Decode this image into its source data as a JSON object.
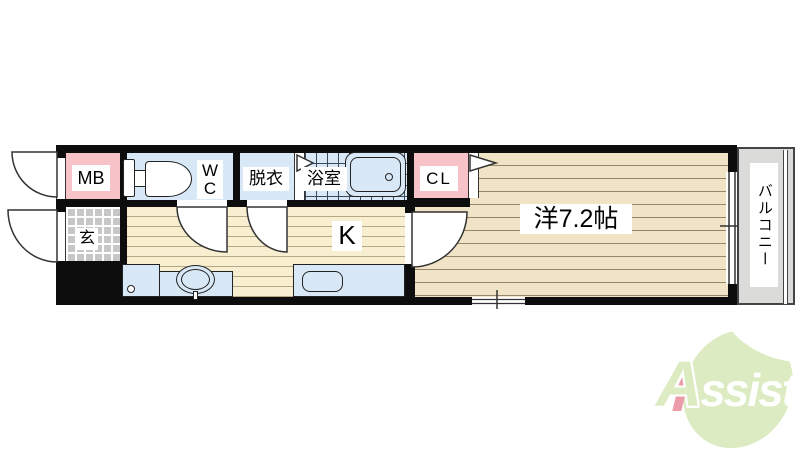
{
  "plan": {
    "labels": {
      "mb": "MB",
      "wc": "W\nC",
      "datsui": "脱衣",
      "bath": "浴室",
      "cl": "CL",
      "entrance": "玄",
      "kitchen": "K",
      "western_room": "洋7.2帖",
      "balcony": "バルコニー"
    },
    "colors": {
      "wall": "#0d0d0d",
      "closet_pink": "#f7c3c8",
      "wet_area_blue": "#d9e8f6",
      "living_floor": "#f1e3c5",
      "kitchen_floor": "#f8efd1",
      "entrance_tile": "#c7c7c7",
      "balcony_gray": "#dbdbd9"
    }
  },
  "logo": {
    "first": "A",
    "rest": "ssist",
    "leaf_color": "#dcebc2",
    "accent_color": "#ec9ba9"
  }
}
